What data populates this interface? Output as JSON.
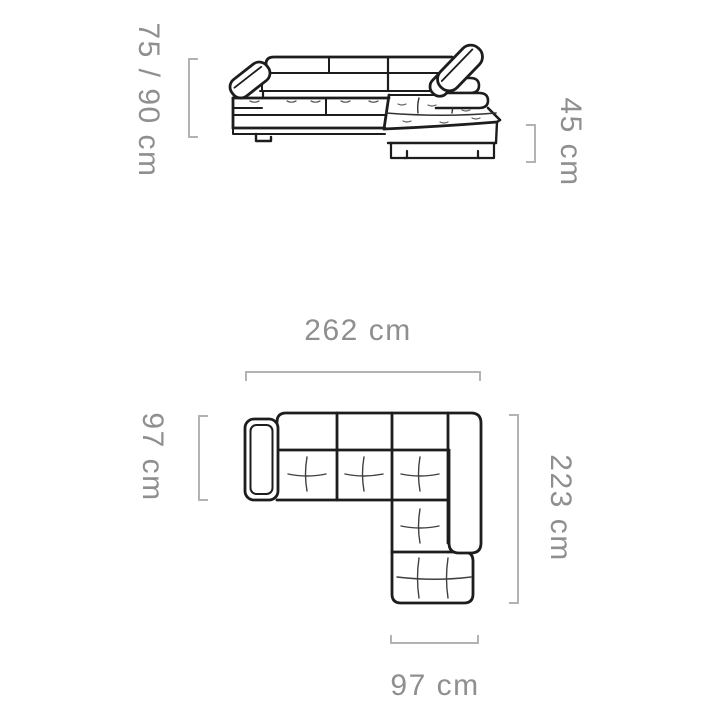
{
  "diagram": {
    "subject": "corner-sofa",
    "views": [
      {
        "id": "front-view",
        "description": "front elevation of corner sofa with headrests and chaise"
      },
      {
        "id": "top-view",
        "description": "top plan of corner sofa with left armrest and chaise"
      }
    ],
    "colors": {
      "background": "#ffffff",
      "sofa_line": "#1d1d1d",
      "dimension_line": "#b3b3b3",
      "label_text": "#8f8f8f"
    }
  },
  "labels": {
    "height": "75 / 90 cm",
    "seat_height": "45 cm",
    "width": "262 cm",
    "side_depth": "97 cm",
    "total_depth": "223 cm",
    "chaise_width": "97 cm"
  }
}
